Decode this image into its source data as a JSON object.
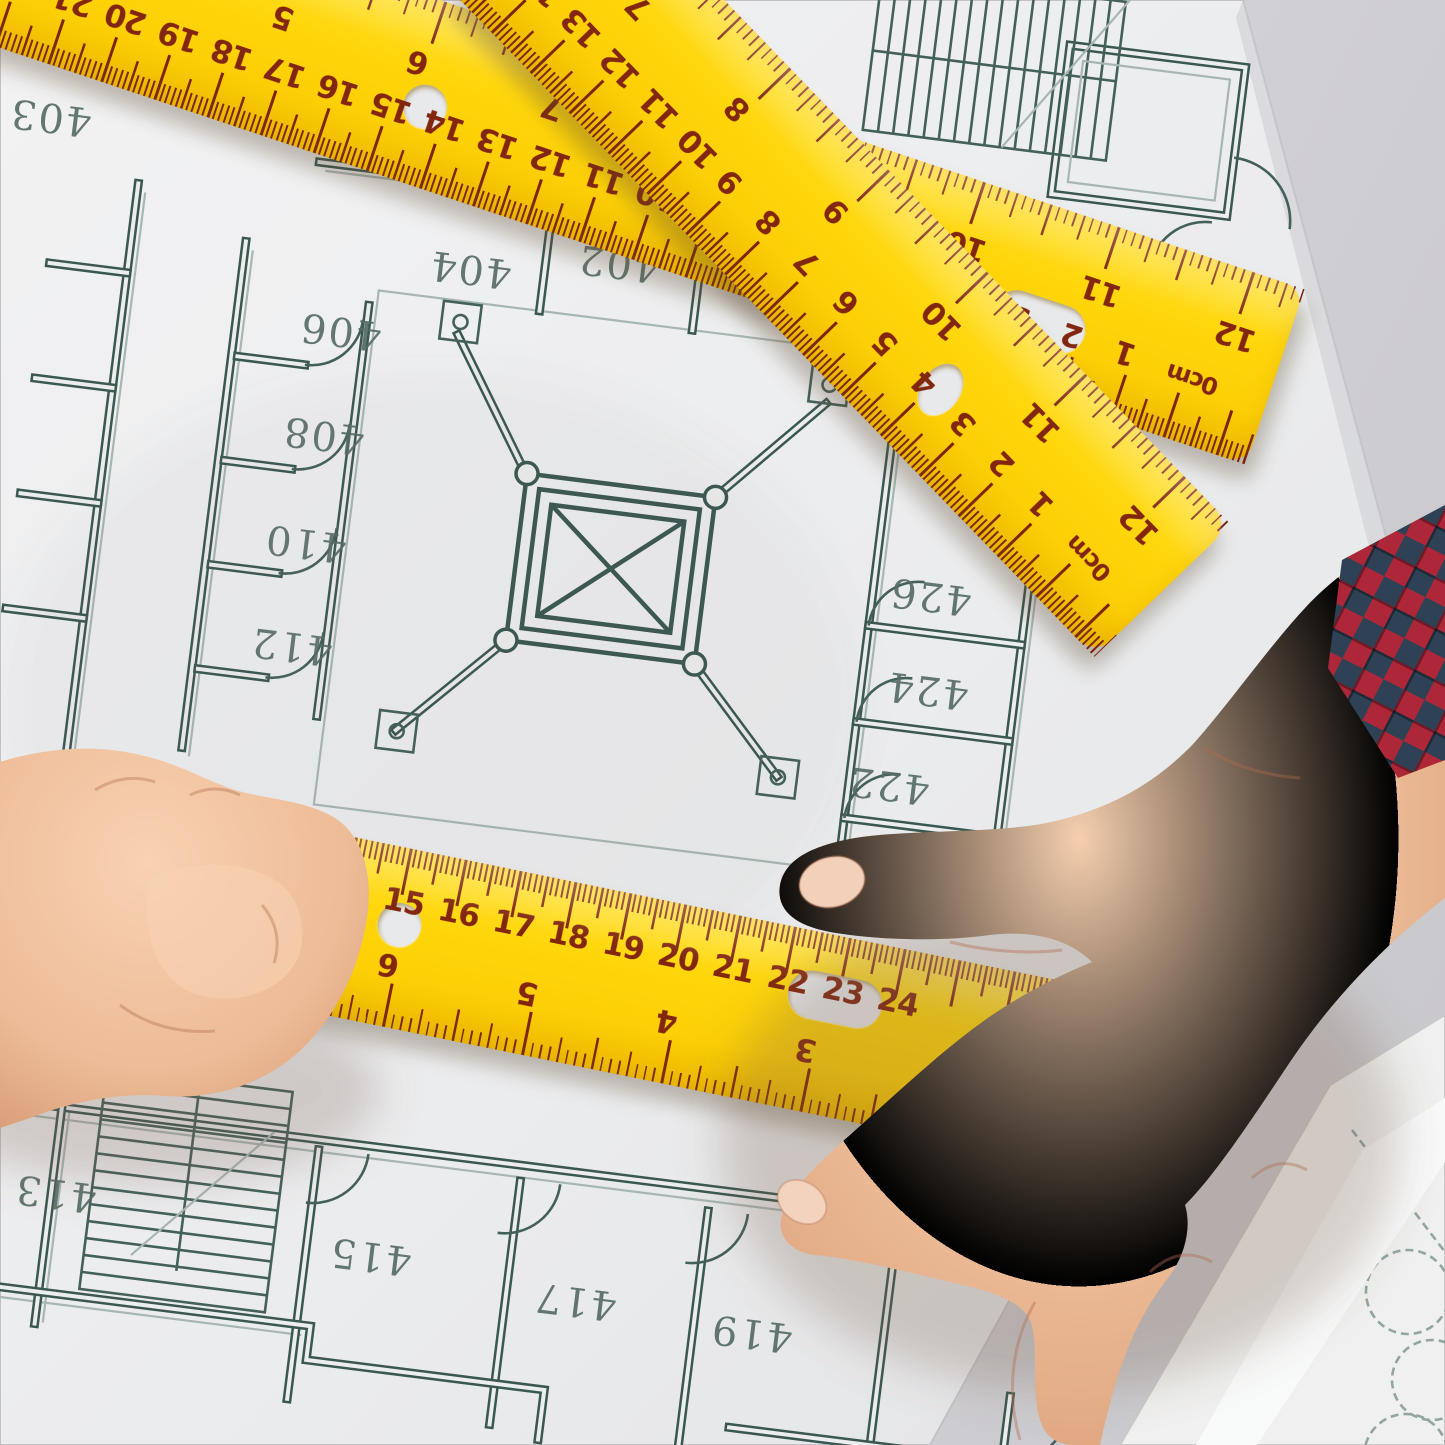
{
  "colors": {
    "ruler_yellow": "#ffd60a",
    "ruler_marking": "#7d230d",
    "blueprint_dark": "#3a5751",
    "blueprint_light": "#a8b6b2",
    "paper": "#ecedee",
    "desk": "#d2d1d5",
    "skin": "#edbb97",
    "plaid_red": "#b02c3a",
    "plaid_navy": "#2e4155",
    "pencil_green": "#58a94e"
  },
  "rulers": [
    {
      "id": "r1",
      "name": "long-ruler-top",
      "unit_label": "0cm",
      "cm_numbers": [
        "22",
        "21",
        "20",
        "19",
        "18",
        "17",
        "16",
        "15",
        "14",
        "13",
        "12",
        "11",
        "10",
        "9",
        "8",
        "7",
        "6",
        "5",
        "4",
        "3",
        "2",
        "1"
      ],
      "inch_numbers": [
        "5",
        "6",
        "7",
        "8",
        "9",
        "10",
        "11",
        "12"
      ]
    },
    {
      "id": "rC",
      "name": "steep-diagonal-ruler",
      "unit_label": "0cm",
      "cm_numbers": [
        "14",
        "13",
        "12",
        "11",
        "10",
        "9",
        "8",
        "7",
        "6",
        "5",
        "4",
        "3",
        "2",
        "1"
      ],
      "inch_numbers": [
        "7",
        "8",
        "9",
        "10",
        "11",
        "12"
      ]
    },
    {
      "id": "rD",
      "name": "bottom-horizontal-ruler",
      "cm_numbers": [
        "12",
        "13",
        "14",
        "15",
        "16",
        "17",
        "18",
        "19",
        "20",
        "21",
        "22",
        "23",
        "24"
      ],
      "inch_numbers": [
        "7",
        "6",
        "5",
        "4",
        "3"
      ]
    }
  ],
  "blueprint": {
    "room_numbers": [
      "403",
      "404",
      "402",
      "406",
      "408",
      "410",
      "412",
      "426",
      "424",
      "422",
      "413",
      "415",
      "417",
      "419"
    ]
  }
}
